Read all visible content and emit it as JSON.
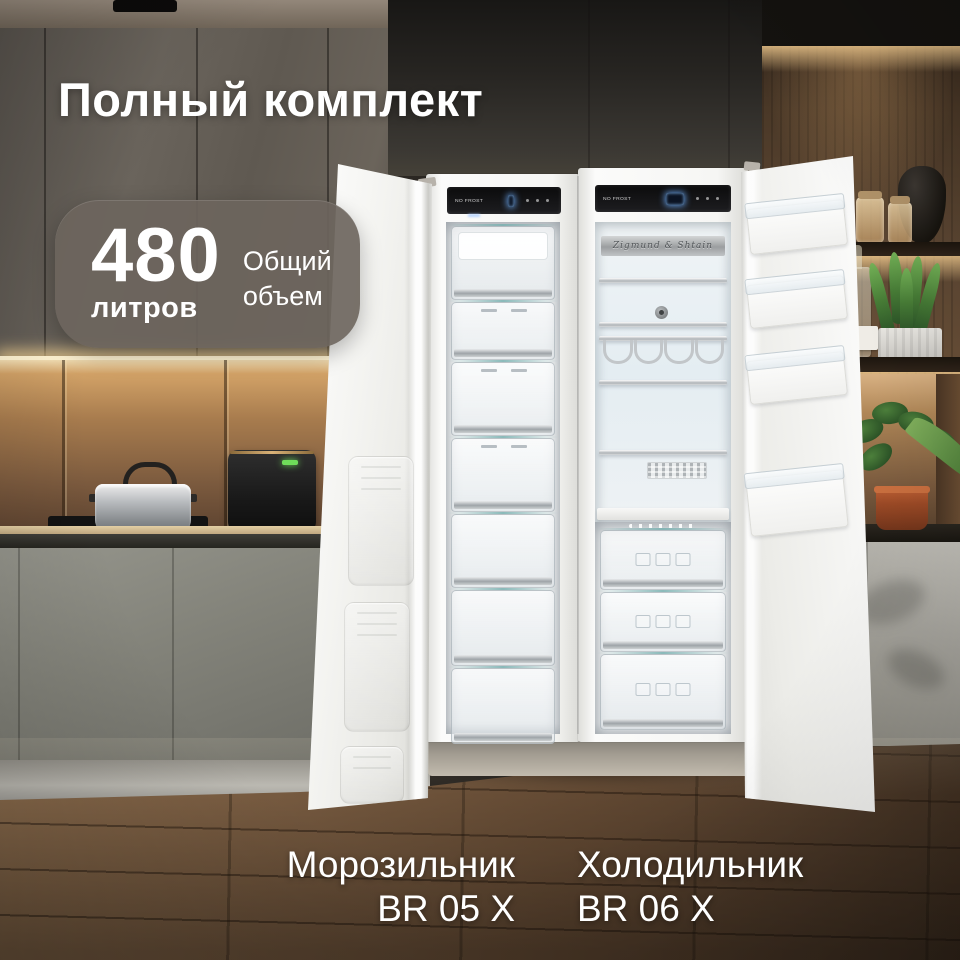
{
  "overlay": {
    "title": "Полный комплект",
    "badge": {
      "value": "480",
      "unit": "литров",
      "caption": "Общий объем"
    },
    "products": [
      {
        "name": "Морозильник",
        "model": "BR 05 X"
      },
      {
        "name": "Холодильник",
        "model": "BR 06 X"
      }
    ]
  },
  "appliances": {
    "brand_plate": "Zigmund & Shtain",
    "freezer_panel_label": "NO FROST",
    "fridge_panel_label": "NO FROST"
  },
  "colors": {
    "text": "#ffffff",
    "badge_bg": "#6d655d",
    "display_glow": "#7fb8ff",
    "warm_light": "#ffd596",
    "wood_floor": "#6b5440"
  }
}
